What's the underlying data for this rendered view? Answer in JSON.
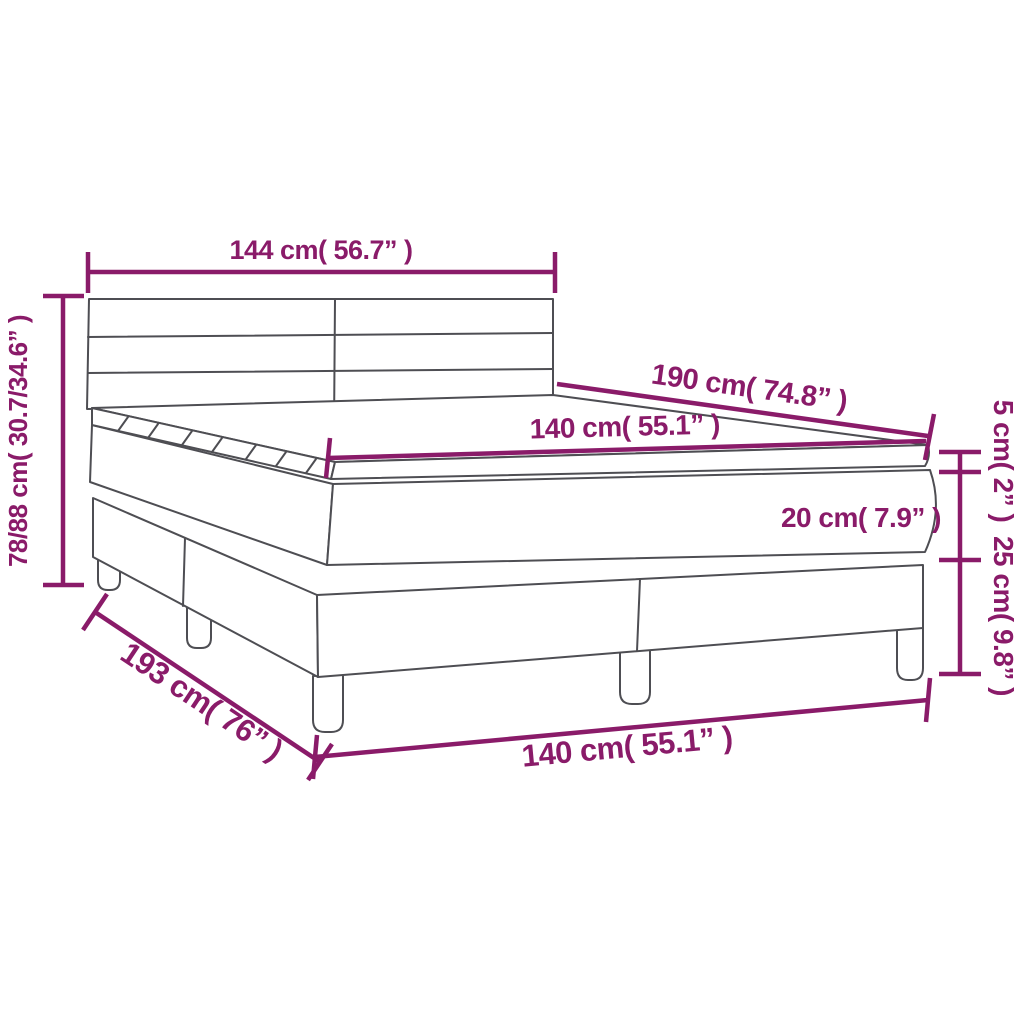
{
  "diagram": {
    "title": "Box spring bed with mattress and topper - dimension diagram",
    "accent_color": "#8a1b69",
    "line_color": "#4e4e53",
    "background": "#ffffff",
    "dims": {
      "headboard_width": {
        "label": "144 cm( 56.7” )",
        "cm": "144",
        "inches": "56.7"
      },
      "bed_height": {
        "label": "78/88 cm( 30.7/34.6” )",
        "cm": "78/88",
        "inches": "30.7/34.6"
      },
      "mattress_length": {
        "label": "190 cm( 74.8” )",
        "cm": "190",
        "inches": "74.8"
      },
      "mattress_width": {
        "label": "140 cm( 55.1” )",
        "cm": "140",
        "inches": "55.1"
      },
      "topper_thickness": {
        "label": "5 cm( 2” )",
        "cm": "5",
        "inches": "2"
      },
      "mattress_thickness": {
        "label": "20 cm( 7.9” )",
        "cm": "20",
        "inches": "7.9"
      },
      "base_height": {
        "label": "25 cm( 9.8” )",
        "cm": "25",
        "inches": "9.8"
      },
      "bed_length": {
        "label": "193 cm( 76” )",
        "cm": "193",
        "inches": "76"
      },
      "bed_width_bottom": {
        "label": "140 cm( 55.1” )",
        "cm": "140",
        "inches": "55.1"
      }
    }
  }
}
